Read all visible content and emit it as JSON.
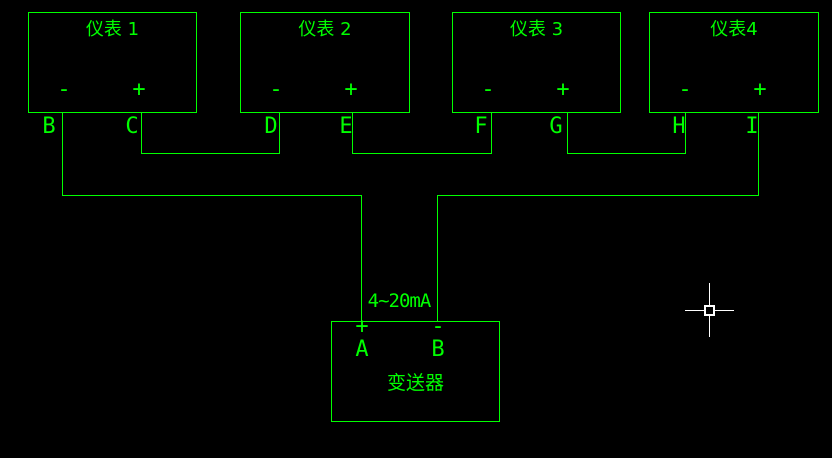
{
  "app": {
    "type": "cad-drawing-canvas",
    "background_color": "#000000",
    "entity_color": "#00ff00",
    "cursor_color": "#ffffff"
  },
  "instruments": [
    {
      "title": "仪表 1",
      "minus_sign": "-",
      "plus_sign": "+",
      "minus_wire_label": "B",
      "plus_wire_label": "C"
    },
    {
      "title": "仪表 2",
      "minus_sign": "-",
      "plus_sign": "+",
      "minus_wire_label": "D",
      "plus_wire_label": "E"
    },
    {
      "title": "仪表 3",
      "minus_sign": "-",
      "plus_sign": "+",
      "minus_wire_label": "F",
      "plus_wire_label": "G"
    },
    {
      "title": "仪表4",
      "minus_sign": "-",
      "plus_sign": "+",
      "minus_wire_label": "H",
      "plus_wire_label": "I"
    }
  ],
  "transmitter": {
    "title": "变送器",
    "signal_label": "4~20mA",
    "plus_sign": "+",
    "plus_terminal_label": "A",
    "minus_sign": "-",
    "minus_terminal_label": "B"
  }
}
